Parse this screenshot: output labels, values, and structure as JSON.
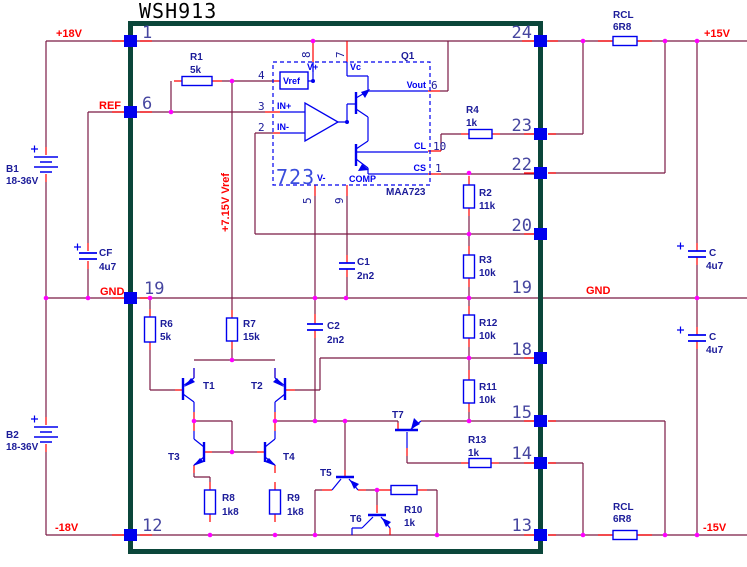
{
  "title": "WSH913",
  "colors": {
    "wire": "#7B1A45",
    "lead": "#FF0000",
    "component_outline": "#0000EE",
    "junction": "#FF00FF",
    "module_border": "#0B463A",
    "net_label": "#FF0000",
    "component_label": "#1B1B99",
    "pin_number": "#4646A0",
    "ic_text": "#3B4EDC"
  },
  "rails": {
    "plus18": "+18V",
    "minus18": "-18V",
    "plus15": "+15V",
    "minus15": "-15V",
    "gnd_left": "GND",
    "gnd_right": "GND",
    "ref": "REF",
    "vref_rail": "+7.15V Vref"
  },
  "pins": {
    "p1": "1",
    "p6": "6",
    "p19_left": "19",
    "p12": "12",
    "p24": "24",
    "p23": "23",
    "p22": "22",
    "p20": "20",
    "p19_right": "19",
    "p18": "18",
    "p15": "15",
    "p14": "14",
    "p13": "13"
  },
  "ic": {
    "big": "723",
    "part": "MAA723",
    "q1": "Q1",
    "vref": "Vref",
    "vplus": "V+",
    "vc": "Vc",
    "vminus": "V-",
    "comp": "COMP",
    "inplus": "IN+",
    "inminus": "IN-",
    "vout": "Vout",
    "cl": "CL",
    "cs": "CS",
    "n8": "8",
    "n7": "7",
    "n4": "4",
    "n3": "3",
    "n2": "2",
    "n5": "5",
    "n9": "9",
    "n6": "6",
    "n10": "10",
    "n1": "1"
  },
  "components": {
    "r1": {
      "n": "R1",
      "v": "5k"
    },
    "r2": {
      "n": "R2",
      "v": "11k"
    },
    "r3": {
      "n": "R3",
      "v": "10k"
    },
    "r4": {
      "n": "R4",
      "v": "1k"
    },
    "r6": {
      "n": "R6",
      "v": "5k"
    },
    "r7": {
      "n": "R7",
      "v": "15k"
    },
    "r8": {
      "n": "R8",
      "v": "1k8"
    },
    "r9": {
      "n": "R9",
      "v": "1k8"
    },
    "r10": {
      "n": "R10",
      "v": "1k"
    },
    "r11": {
      "n": "R11",
      "v": "10k"
    },
    "r12": {
      "n": "R12",
      "v": "10k"
    },
    "r13": {
      "n": "R13",
      "v": "1k"
    },
    "rcl_top": {
      "n": "RCL",
      "v": "6R8"
    },
    "rcl_bottom": {
      "n": "RCL",
      "v": "6R8"
    },
    "c1": {
      "n": "C1",
      "v": "2n2"
    },
    "c2": {
      "n": "C2",
      "v": "2n2"
    },
    "cf": {
      "n": "CF",
      "v": "4u7"
    },
    "c_top": {
      "n": "C",
      "v": "4u7"
    },
    "c_bottom": {
      "n": "C",
      "v": "4u7"
    },
    "b1": {
      "n": "B1",
      "v": "18-36V"
    },
    "b2": {
      "n": "B2",
      "v": "18-36V"
    },
    "t1": "T1",
    "t2": "T2",
    "t3": "T3",
    "t4": "T4",
    "t5": "T5",
    "t6": "T6",
    "t7": "T7"
  }
}
